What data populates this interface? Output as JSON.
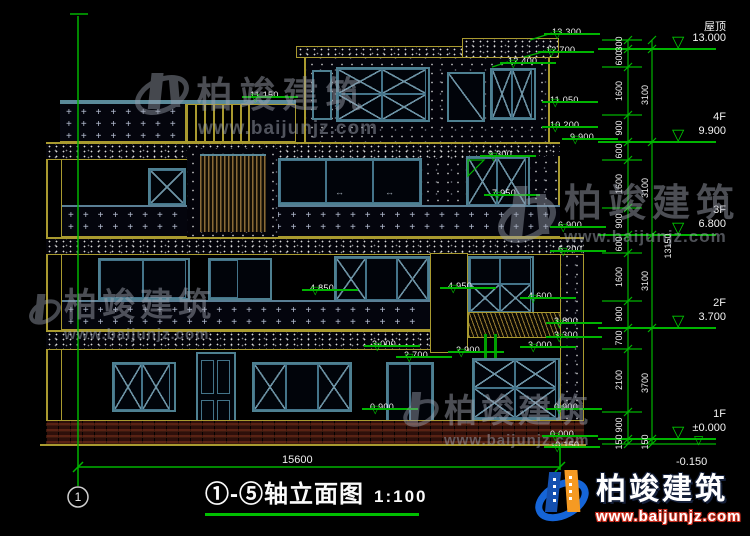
{
  "drawing": {
    "title": "①-⑤轴立面图",
    "scale": "1:100",
    "axis_bubble": "1",
    "bottom_dim": "15600",
    "total_dim": "13150",
    "bottom_right_offset": "-0.150"
  },
  "floors": [
    {
      "name": "屋顶",
      "elev": "13.000",
      "y": 49
    },
    {
      "name": "4F",
      "elev": "9.900",
      "y": 142
    },
    {
      "name": "3F",
      "elev": "6.800",
      "y": 235
    },
    {
      "name": "2F",
      "elev": "3.700",
      "y": 328
    },
    {
      "name": "1F",
      "elev": "±0.000",
      "y": 439
    }
  ],
  "dim_minor": [
    {
      "v": "300",
      "y": 44
    },
    {
      "v": "600",
      "y": 58
    },
    {
      "v": "1600",
      "y": 91
    },
    {
      "v": "900",
      "y": 128
    },
    {
      "v": "600",
      "y": 151
    },
    {
      "v": "1600",
      "y": 184
    },
    {
      "v": "900",
      "y": 221
    },
    {
      "v": "600",
      "y": 244
    },
    {
      "v": "1600",
      "y": 277
    },
    {
      "v": "900",
      "y": 314
    },
    {
      "v": "700",
      "y": 338
    },
    {
      "v": "2100",
      "y": 380
    },
    {
      "v": "900",
      "y": 425
    },
    {
      "v": "150",
      "y": 442
    }
  ],
  "dim_major": [
    {
      "v": "3100",
      "y": 95
    },
    {
      "v": "3100",
      "y": 188
    },
    {
      "v": "3100",
      "y": 281
    },
    {
      "v": "3700",
      "y": 383
    },
    {
      "v": "150",
      "y": 442
    }
  ],
  "elev_markers": [
    {
      "v": "11.150",
      "x": 250,
      "y": 85
    },
    {
      "v": "13.300",
      "x": 552,
      "y": 22
    },
    {
      "v": "12.700",
      "x": 546,
      "y": 40
    },
    {
      "v": "12.400",
      "x": 508,
      "y": 51
    },
    {
      "v": "11.050",
      "x": 550,
      "y": 90
    },
    {
      "v": "10.200",
      "x": 550,
      "y": 115
    },
    {
      "v": "9.900",
      "x": 570,
      "y": 127
    },
    {
      "v": "9.300",
      "x": 488,
      "y": 144
    },
    {
      "v": "7.950",
      "x": 492,
      "y": 183
    },
    {
      "v": "6.900",
      "x": 558,
      "y": 215
    },
    {
      "v": "6.200",
      "x": 558,
      "y": 239
    },
    {
      "v": "4.850",
      "x": 310,
      "y": 278
    },
    {
      "v": "4.950",
      "x": 448,
      "y": 276
    },
    {
      "v": "4.600",
      "x": 528,
      "y": 286
    },
    {
      "v": "3.800",
      "x": 554,
      "y": 311
    },
    {
      "v": "3.300",
      "x": 554,
      "y": 325
    },
    {
      "v": "3.000",
      "x": 372,
      "y": 334
    },
    {
      "v": "2.900",
      "x": 456,
      "y": 340
    },
    {
      "v": "2.700",
      "x": 404,
      "y": 345
    },
    {
      "v": "3.000",
      "x": 528,
      "y": 335
    },
    {
      "v": "0.900",
      "x": 370,
      "y": 397
    },
    {
      "v": "0.900",
      "x": 554,
      "y": 397
    },
    {
      "v": "0.000",
      "x": 550,
      "y": 424
    },
    {
      "v": "-0.150",
      "x": 552,
      "y": 435
    }
  ],
  "brand": {
    "name": "柏竣建筑",
    "url": "www.baijunjz.com"
  },
  "texture": {
    "plus": "+"
  }
}
